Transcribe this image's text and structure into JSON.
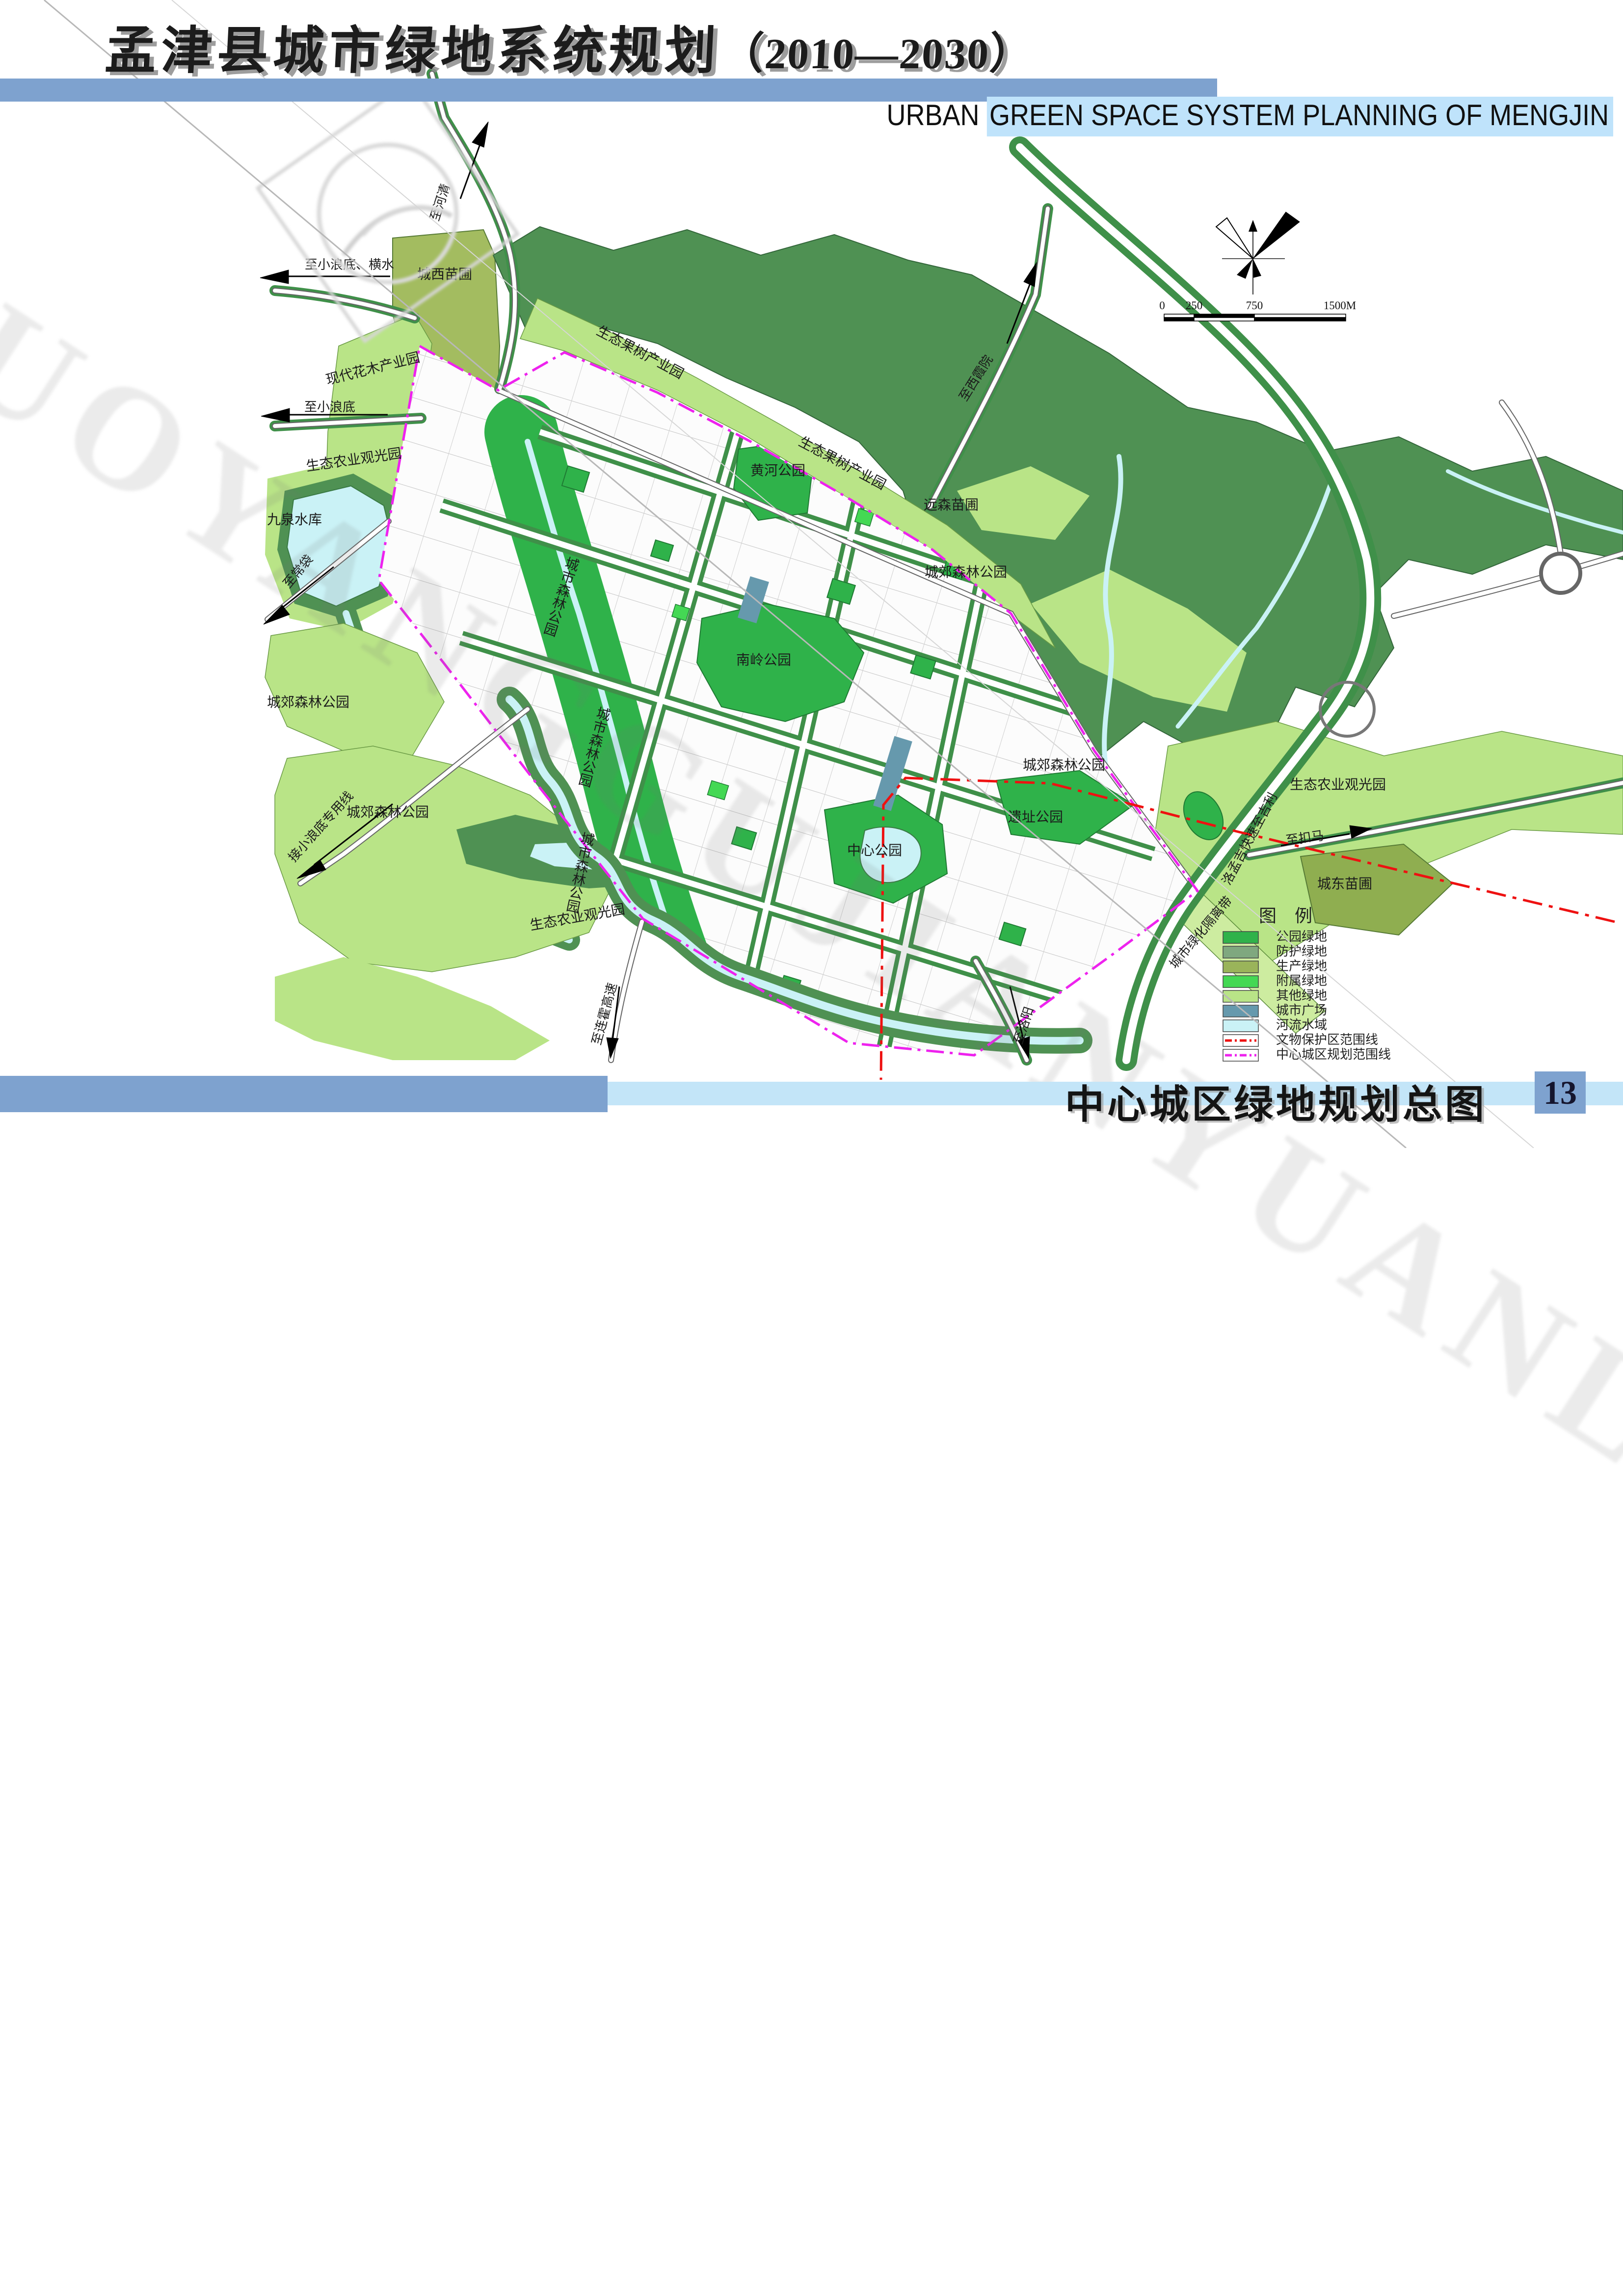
{
  "header": {
    "title_cn": "孟津县城市绿地系统规划",
    "title_years": "（2010—2030）",
    "subtitle_prefix": "URBAN ",
    "subtitle_highlight": "GREEN SPACE SYSTEM PLANNING OF MENGJIN"
  },
  "footer": {
    "caption": "中心城区绿地规划总图",
    "page_number": "13"
  },
  "watermark": {
    "text": "LUOYANGGUJIANYUANLINSHEJIYUANYOUXIANGONGSI"
  },
  "colors": {
    "band_blue": "#7ea2cf",
    "band_light_blue": "#c3e5f8",
    "highlight_blue": "#bfe3fb",
    "park_green": "#2fb24a",
    "protect_green": "#7fa87f",
    "production_green": "#9ab45a",
    "attached_green": "#44d854",
    "other_green": "#b9e487",
    "plaza_blue": "#6699ad",
    "water_cyan": "#caf2f6",
    "forest_dark": "#4f9153",
    "heritage_red": "#ee1111",
    "boundary_magenta": "#ee22ee"
  },
  "legend": {
    "title": "图 例",
    "items": [
      {
        "label": "公园绿地"
      },
      {
        "label": "防护绿地"
      },
      {
        "label": "生产绿地"
      },
      {
        "label": "附属绿地"
      },
      {
        "label": "其他绿地"
      },
      {
        "label": "城市广场"
      },
      {
        "label": "河流水域"
      },
      {
        "label": "文物保护区范围线"
      },
      {
        "label": "中心城区规划范围线"
      }
    ]
  },
  "scale_bar": {
    "tick0": "0",
    "tick1": "250",
    "tick2": "750",
    "tick3": "1500M"
  },
  "map_labels": [
    {
      "text": "现代花木产业园"
    },
    {
      "text": "城西苗圃"
    },
    {
      "text": "至小浪底、横水"
    },
    {
      "text": "至河清"
    },
    {
      "text": "至小浪底"
    },
    {
      "text": "生态农业观光园"
    },
    {
      "text": "九泉水库"
    },
    {
      "text": "至常袋"
    },
    {
      "text": "城郊森林公园"
    },
    {
      "text": "接小浪底专用线"
    },
    {
      "text": "城郊森林公园"
    },
    {
      "text": "生态农业观光园"
    },
    {
      "text": "至连霍高速"
    },
    {
      "text": "至洛阳"
    },
    {
      "text": "生态果树产业园"
    },
    {
      "text": "黄河公园"
    },
    {
      "text": "生态果树产业园"
    },
    {
      "text": "远森苗圃"
    },
    {
      "text": "至西霞院"
    },
    {
      "text": "城郊森林公园"
    },
    {
      "text": "城郊森林公园"
    },
    {
      "text": "生态农业观光园"
    },
    {
      "text": "至扣马"
    },
    {
      "text": "城东苗圃"
    },
    {
      "text": "洛孟吉快速至吉利"
    },
    {
      "text": "城市绿化隔离带"
    },
    {
      "text": "遗址公园"
    },
    {
      "text": "中心公园"
    },
    {
      "text": "南岭公园"
    },
    {
      "text": "城市森林公园"
    },
    {
      "text": "城市森林公园"
    },
    {
      "text": "城市森林公园"
    }
  ]
}
